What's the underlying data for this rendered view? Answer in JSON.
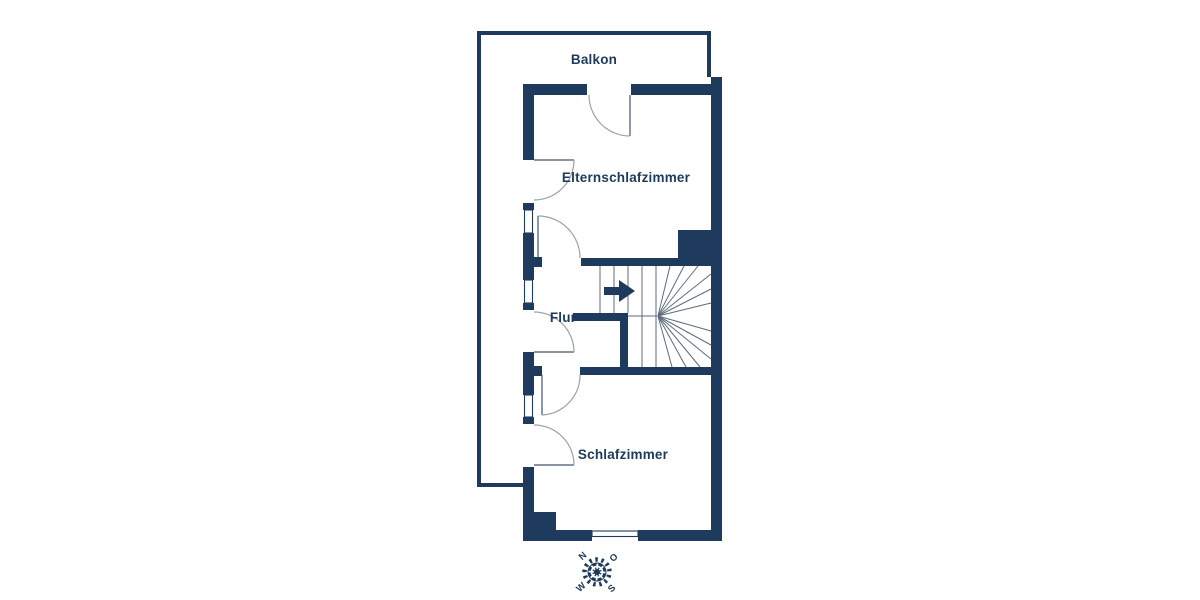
{
  "floorplan": {
    "title": "apartment upper floor plan",
    "rooms": [
      {
        "id": "balkon",
        "label": "Balkon"
      },
      {
        "id": "elternschlafzimmer",
        "label": "Elternschlafzimmer"
      },
      {
        "id": "flur",
        "label": "Flur"
      },
      {
        "id": "schlafzimmer",
        "label": "Schlafzimmer"
      }
    ],
    "compass": {
      "n": "N",
      "e": "O",
      "s": "S",
      "w": "W",
      "rotation_deg": -42
    },
    "icons": {
      "stair_direction": "right-arrow",
      "orientation": "compass-rose"
    },
    "colors": {
      "wall": "#1e3a5c",
      "arc": "#9aa2ab",
      "stair": "#5d6b7c",
      "leaf": "#44546a",
      "background": "#ffffff"
    }
  }
}
